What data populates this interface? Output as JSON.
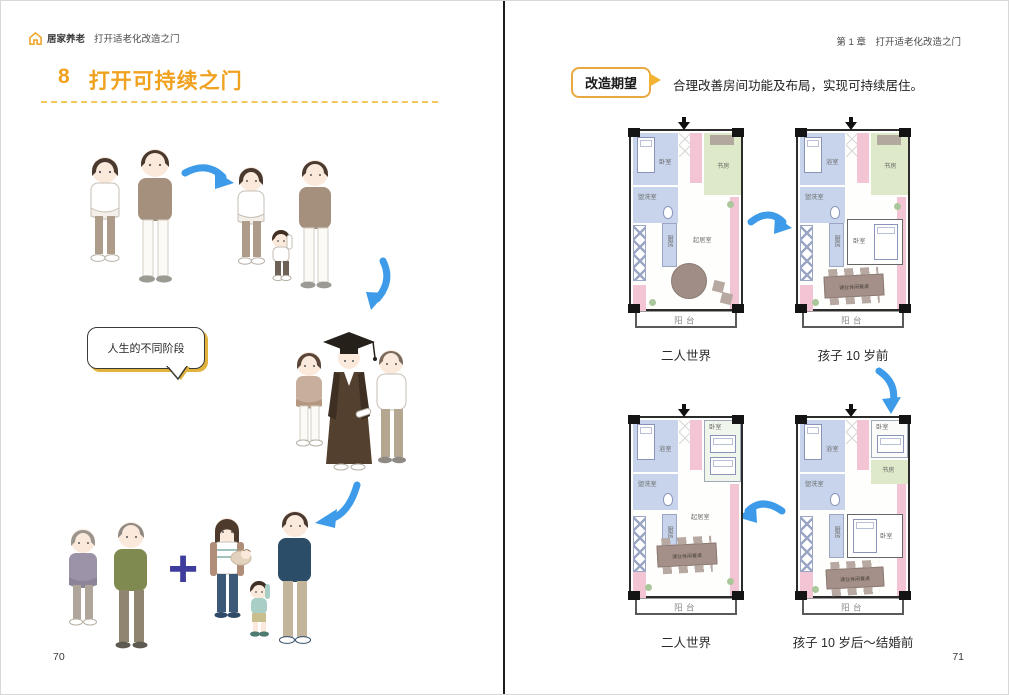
{
  "left_page": {
    "header": {
      "brand": "居家养老",
      "chapter": "打开适老化改造之门"
    },
    "section_number": "8",
    "section_title": "打开可持续之门",
    "bubble_text": "人生的不同阶段",
    "plus": "+",
    "page_number": "70"
  },
  "right_page": {
    "header": "第 1 章　打开适老化改造之门",
    "badge_label": "改造期望",
    "lead_text": "合理改善房间功能及布局，实现可持续居住。",
    "plans": {
      "a": {
        "caption": "二人世界",
        "bedroom": "卧室",
        "washroom": "盥洗室",
        "study": "书房",
        "kitchen": "厨房",
        "living": "起居室",
        "balcony": "阳台"
      },
      "b": {
        "caption": "孩子 10 岁前",
        "bath": "浴室",
        "washroom": "盥洗室",
        "study": "书房",
        "kitchen": "厨房",
        "bedroom": "卧室",
        "table": "课业休闲餐桌",
        "balcony": "阳台"
      },
      "c": {
        "caption": "二人世界",
        "bath": "浴室",
        "washroom": "盥洗室",
        "bedroom": "卧室",
        "kitchen": "厨房",
        "living": "起居室",
        "table": "课业休闲餐桌",
        "balcony": "阳台"
      },
      "d": {
        "caption": "孩子 10 岁后～结婚前",
        "bath": "浴室",
        "washroom": "盥洗室",
        "bedroom_top": "卧室",
        "study": "书房",
        "bedroom_bottom": "卧室",
        "kitchen": "厨房",
        "table": "课业休闲餐桌",
        "balcony": "阳台"
      },
      "page_number": "71"
    },
    "page_number": "71"
  },
  "colors": {
    "accent_orange": "#F0A11E",
    "arrow_blue": "#3D9BE9",
    "wall_pink": "#F3C4D4",
    "room_blue": "#C7D4EC",
    "room_green": "#DDE9C8",
    "plus_purple": "#3E3C9C",
    "bubble_shadow": "#E2B33C"
  }
}
